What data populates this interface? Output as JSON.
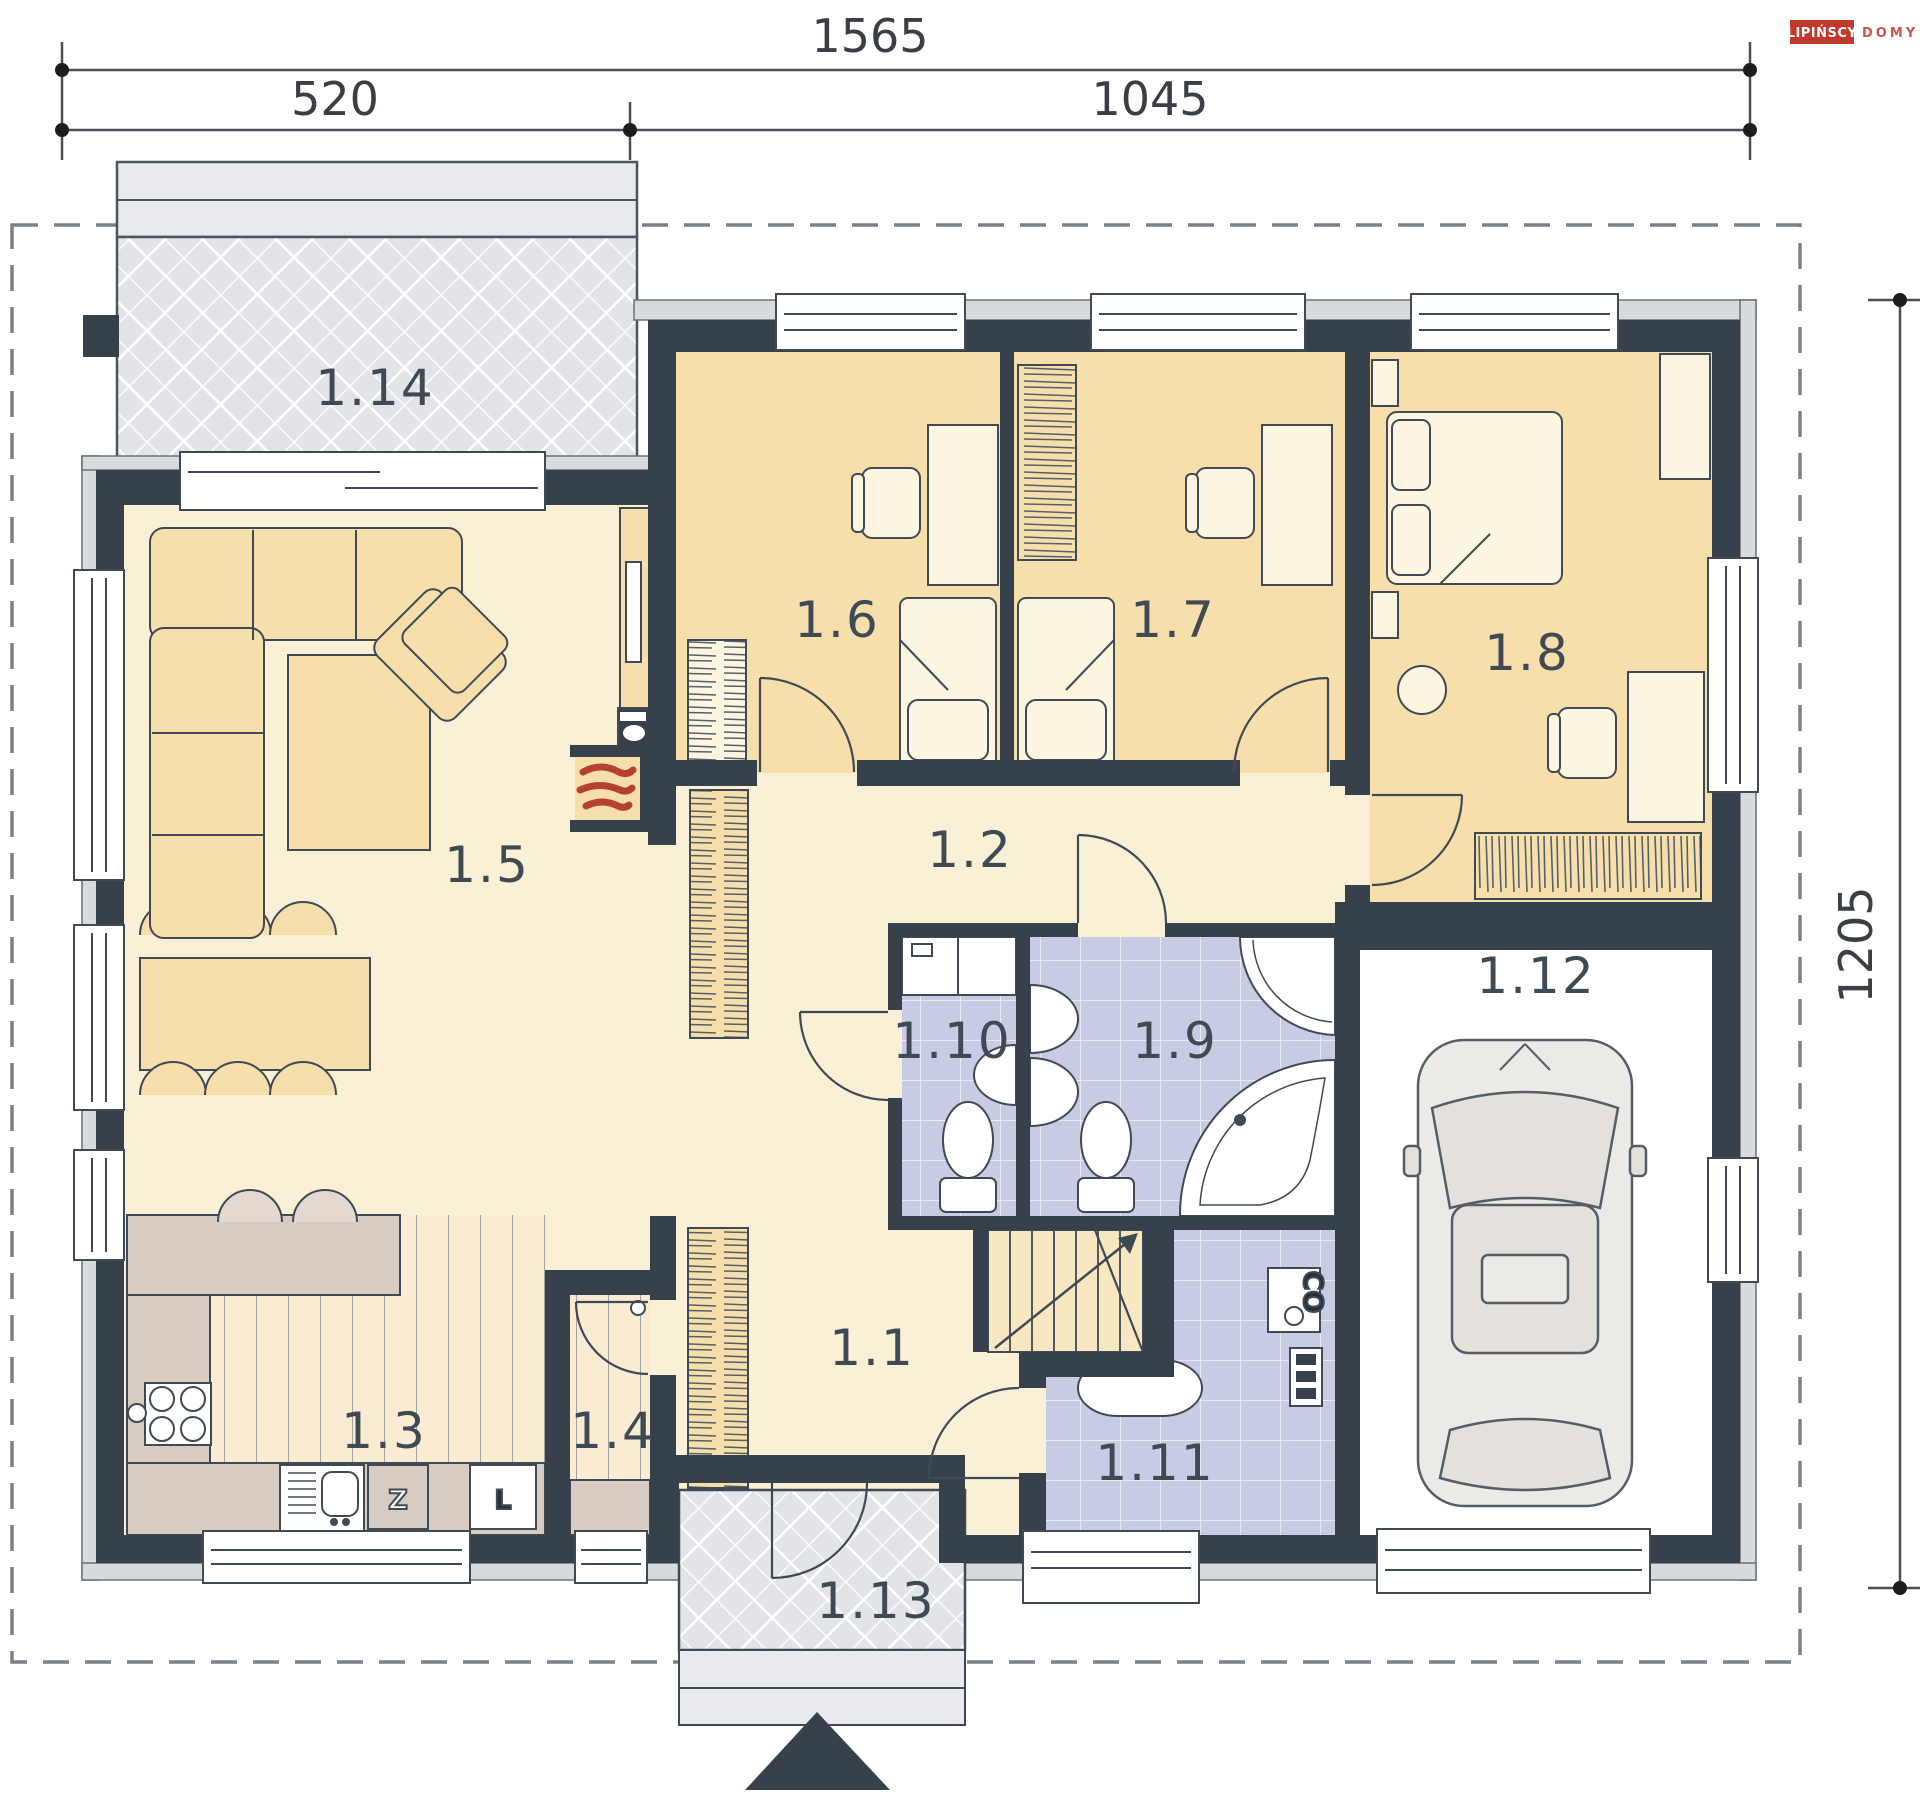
{
  "logo": {
    "brand": "LIPIŃSCY",
    "type": "DOMY"
  },
  "dimensions": {
    "total_width": "1565",
    "left_section": "520",
    "right_section": "1045",
    "depth": "1205"
  },
  "rooms": [
    {
      "id": "hall",
      "label": "1.1"
    },
    {
      "id": "corridor",
      "label": "1.2"
    },
    {
      "id": "kitchen",
      "label": "1.3"
    },
    {
      "id": "pantry",
      "label": "1.4"
    },
    {
      "id": "living-room",
      "label": "1.5"
    },
    {
      "id": "bedroom-1",
      "label": "1.6"
    },
    {
      "id": "bedroom-2",
      "label": "1.7"
    },
    {
      "id": "bedroom-3",
      "label": "1.8"
    },
    {
      "id": "bathroom",
      "label": "1.9"
    },
    {
      "id": "wc",
      "label": "1.10"
    },
    {
      "id": "utility",
      "label": "1.11"
    },
    {
      "id": "garage",
      "label": "1.12"
    },
    {
      "id": "porch",
      "label": "1.13"
    },
    {
      "id": "terrace",
      "label": "1.14"
    }
  ],
  "markers": {
    "sink": "Z",
    "fridge": "L",
    "boiler": "CO"
  },
  "colors": {
    "wall": "#36414b",
    "floor_cream": "#faf0d6",
    "floor_peach": "#f7dfac",
    "floor_lavender": "#c7cce4",
    "floor_terrace": "#e2e4e8",
    "counter_tan": "#d8cbc1",
    "accent_red": "#c0392b"
  }
}
